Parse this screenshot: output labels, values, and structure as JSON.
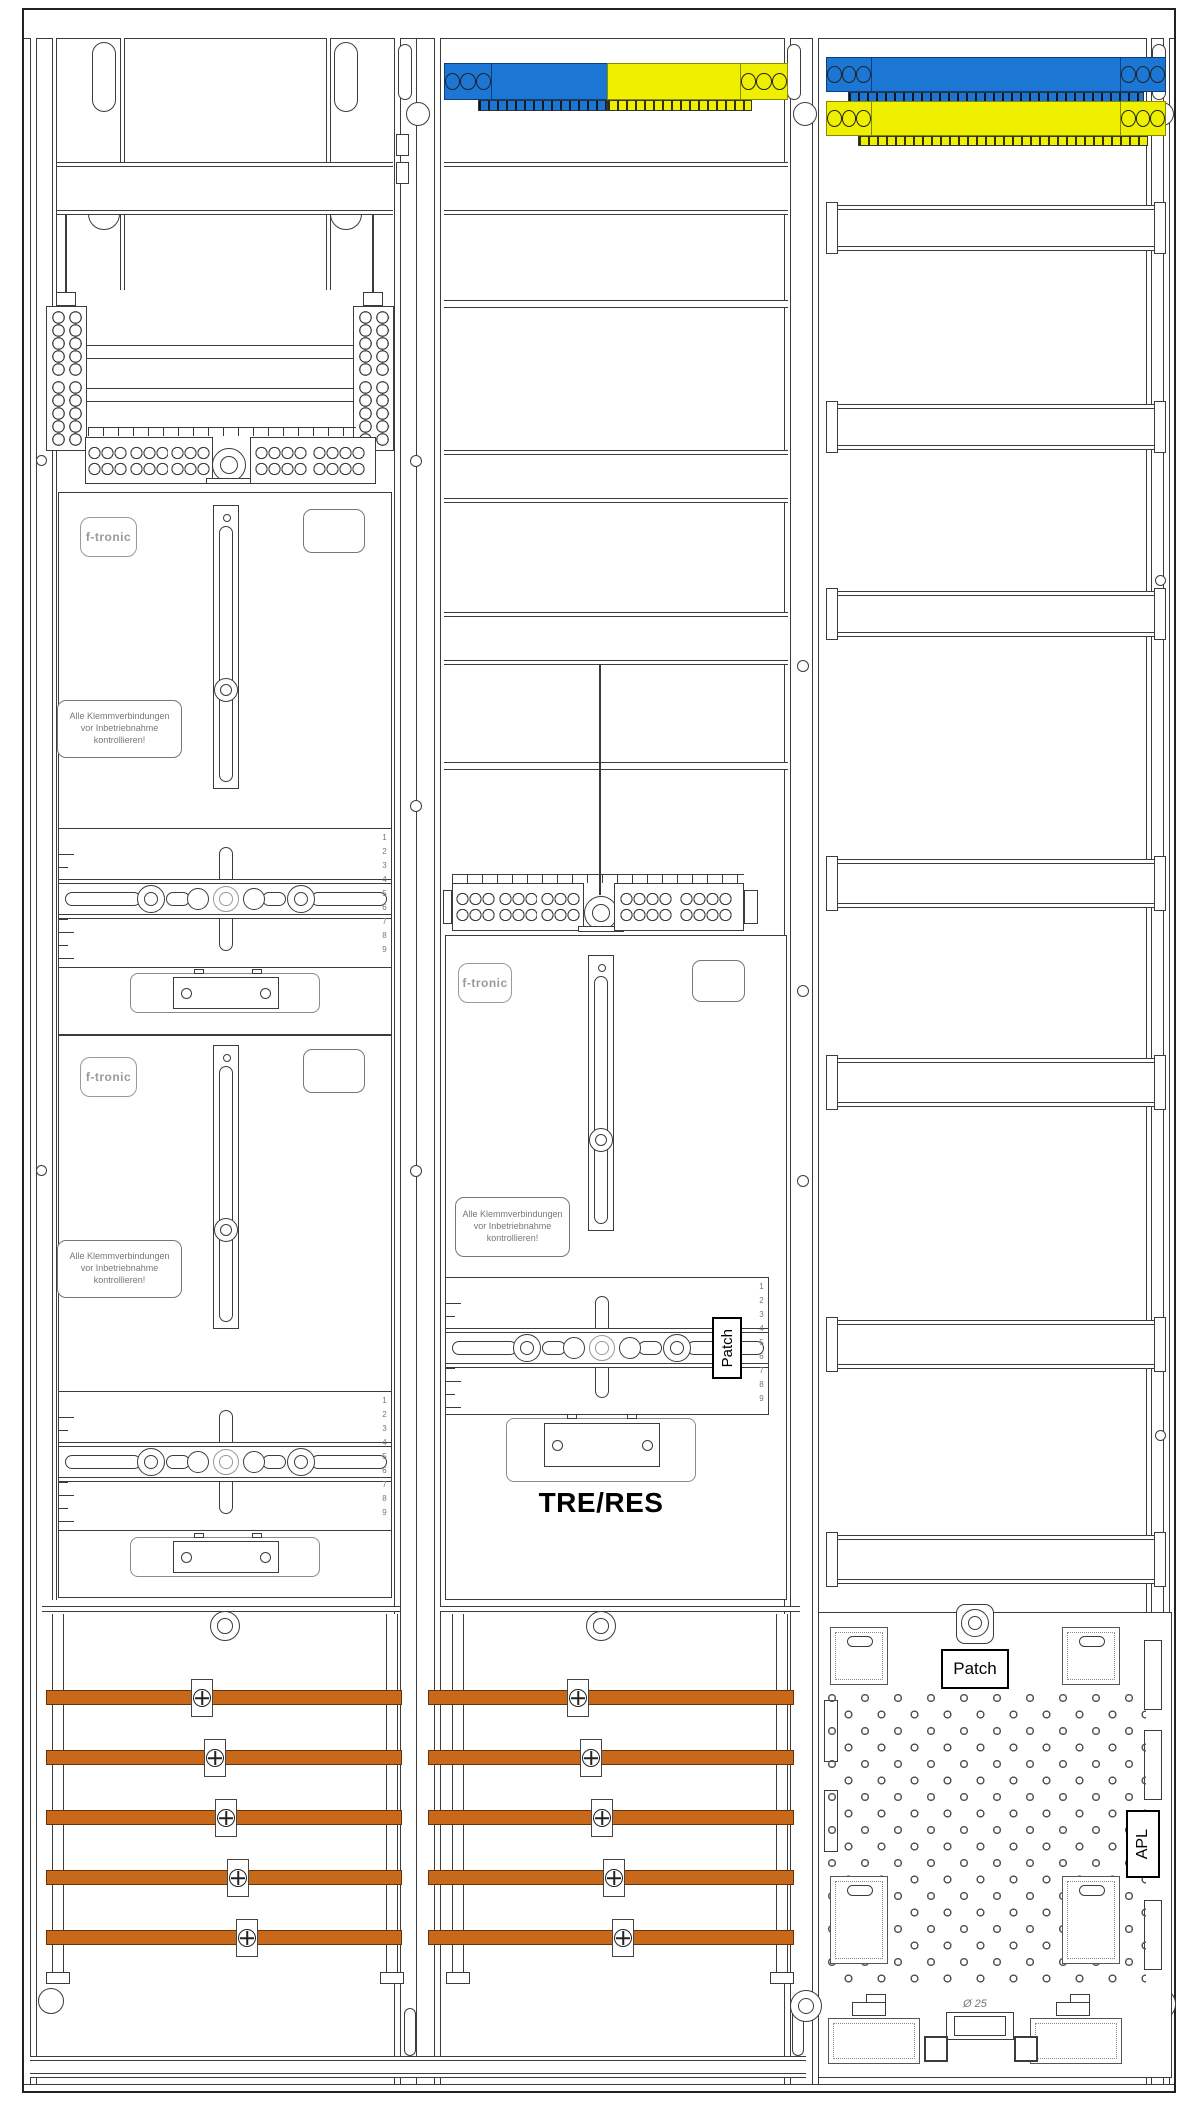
{
  "labels": {
    "brand": "f-tronic",
    "warning_line1": "Alle Klemmverbindungen",
    "warning_line2": "vor Inbetriebnahme",
    "warning_line3": "kontrollieren!",
    "tre_res": "TRE/RES",
    "patch": "Patch",
    "apl": "APL",
    "diameter_note": "Ø 25",
    "ruler_numbers": "123456789"
  },
  "colors": {
    "busbar_copper": "#C7681B",
    "phase_blue": "#1B76D4",
    "phase_yellow": "#EFEF00",
    "line_gray": "#3C3C3C"
  }
}
